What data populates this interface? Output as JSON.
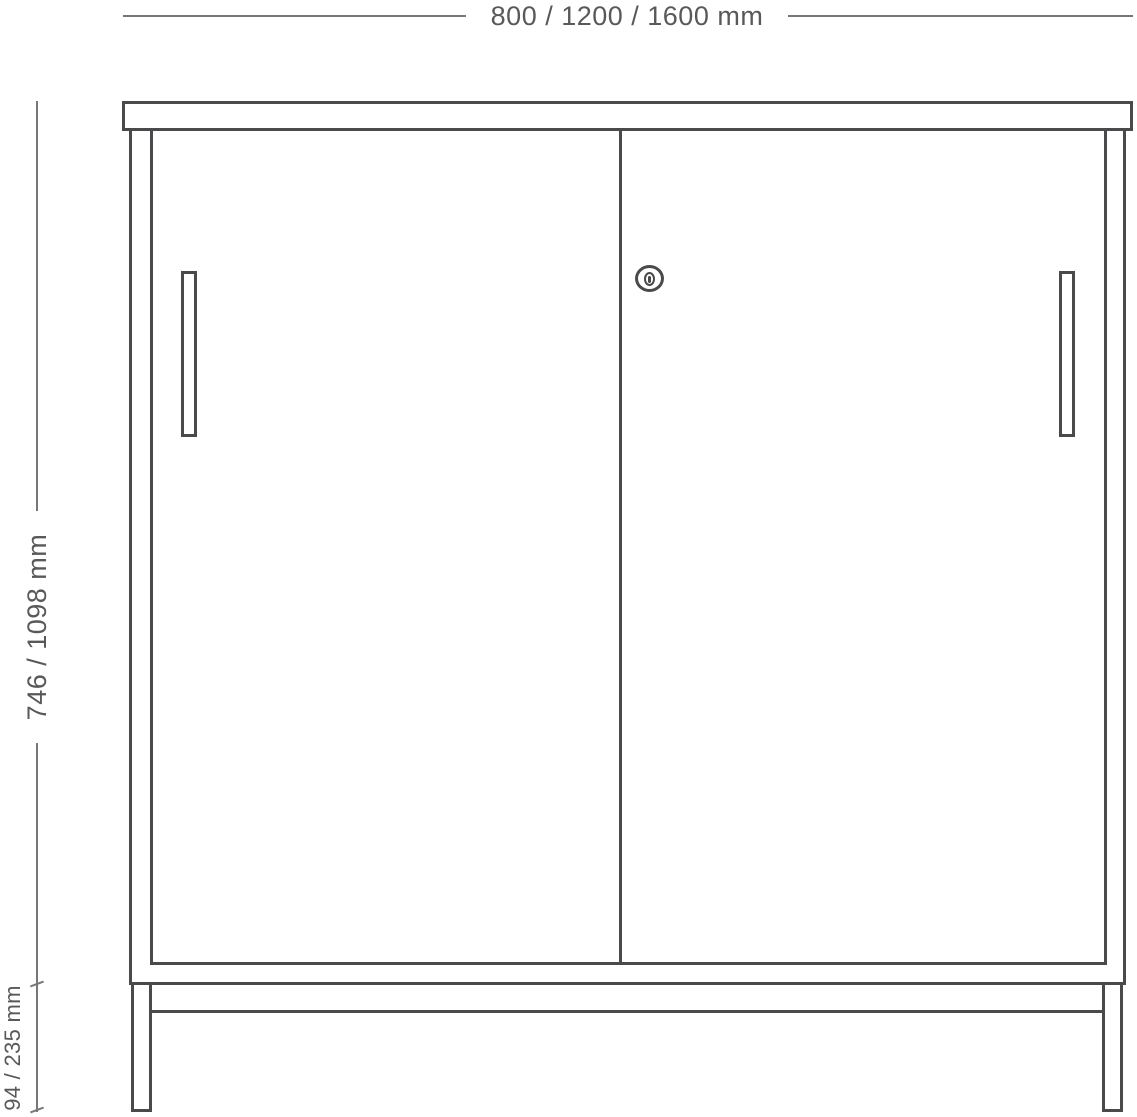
{
  "drawing": {
    "type": "furniture-technical-drawing",
    "subject": "sideboard cabinet with sliding doors on a leg frame"
  },
  "dimensions": {
    "width_label": "800 / 1200 / 1600 mm",
    "height_label": "746 / 1098 mm",
    "base_height_label": "94 / 235 mm"
  },
  "icons": {
    "lock": "lock-icon"
  },
  "colors": {
    "outline": "#4a4a4c",
    "dimension_line": "#77777a",
    "label_text": "#59595b",
    "background": "#ffffff"
  }
}
